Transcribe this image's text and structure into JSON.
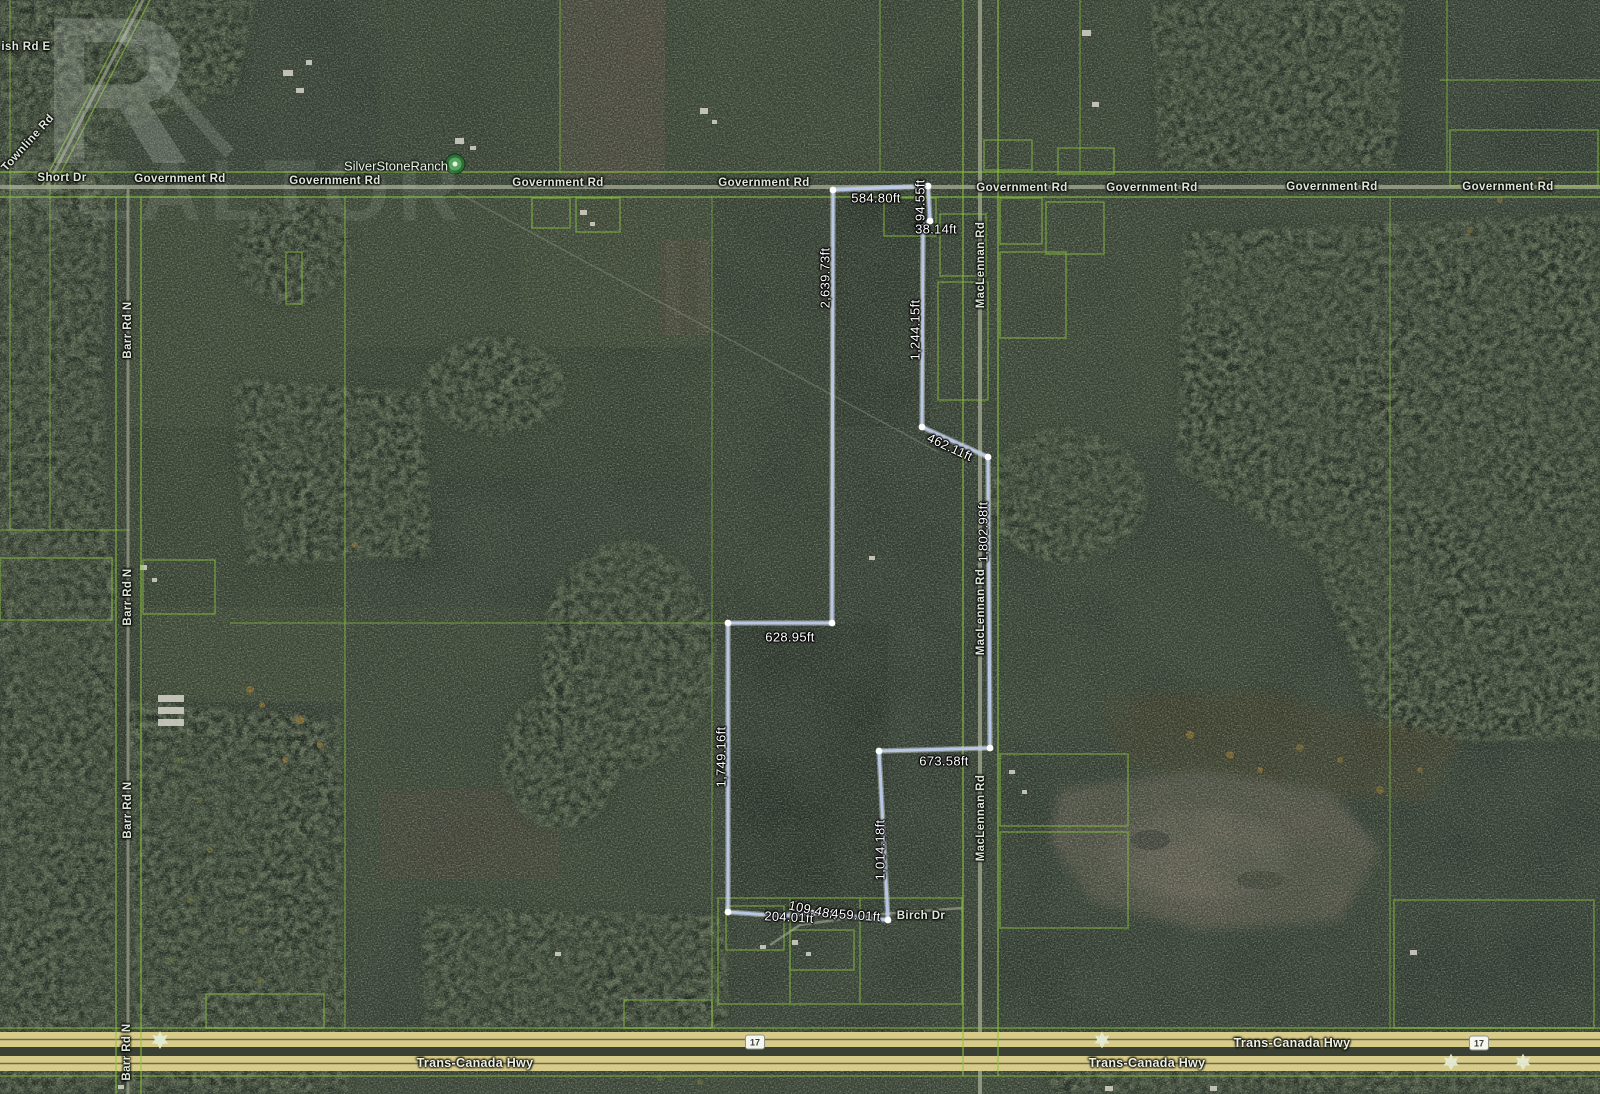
{
  "watermark": {
    "logo_letter": "R",
    "brand": "REALTOR"
  },
  "poi": {
    "name": "SilverStoneRanch"
  },
  "colors": {
    "boundary_line": "#b9c9ea",
    "vertex_dot": "#ffffff",
    "parcel_line": "#8cc63f",
    "highway_fill": "#d6cb88",
    "poi_marker_green": "#2c6e34"
  },
  "road_labels": [
    {
      "text": "ish Rd E",
      "x": 26,
      "y": 47,
      "rotate": 0
    },
    {
      "text": "Townline Rd",
      "x": 28,
      "y": 143,
      "rotate": -48
    },
    {
      "text": "Short Dr",
      "x": 62,
      "y": 178,
      "rotate": 0
    },
    {
      "text": "Government Rd",
      "x": 180,
      "y": 179,
      "rotate": 0
    },
    {
      "text": "Government Rd",
      "x": 335,
      "y": 181,
      "rotate": 0
    },
    {
      "text": "Government Rd",
      "x": 558,
      "y": 183,
      "rotate": 0
    },
    {
      "text": "Government Rd",
      "x": 764,
      "y": 183,
      "rotate": 0
    },
    {
      "text": "Government Rd",
      "x": 1022,
      "y": 188,
      "rotate": 0
    },
    {
      "text": "Government Rd",
      "x": 1152,
      "y": 188,
      "rotate": 0
    },
    {
      "text": "Government Rd",
      "x": 1332,
      "y": 187,
      "rotate": 0
    },
    {
      "text": "Government Rd",
      "x": 1508,
      "y": 187,
      "rotate": 0
    },
    {
      "text": "Barr Rd N",
      "x": 128,
      "y": 330,
      "rotate": -90
    },
    {
      "text": "Barr Rd N",
      "x": 128,
      "y": 597,
      "rotate": -90
    },
    {
      "text": "Barr Rd N",
      "x": 128,
      "y": 810,
      "rotate": -90
    },
    {
      "text": "Barr Rd N",
      "x": 127,
      "y": 1052,
      "rotate": -90
    },
    {
      "text": "MacLennan Rd",
      "x": 981,
      "y": 265,
      "rotate": -90
    },
    {
      "text": "MacLennan Rd",
      "x": 981,
      "y": 612,
      "rotate": -90
    },
    {
      "text": "MacLennan Rd",
      "x": 981,
      "y": 818,
      "rotate": -90
    },
    {
      "text": "Birch Dr",
      "x": 921,
      "y": 916,
      "rotate": 0
    }
  ],
  "highway_labels": [
    {
      "text": "Trans-Canada Hwy",
      "x": 475,
      "y": 1063,
      "rotate": 0
    },
    {
      "text": "Trans-Canada Hwy",
      "x": 1147,
      "y": 1063,
      "rotate": 0
    },
    {
      "text": "Trans-Canada Hwy",
      "x": 1292,
      "y": 1043,
      "rotate": 0
    }
  ],
  "highway_shields": [
    {
      "text": "17",
      "x": 755,
      "y": 1042
    },
    {
      "text": "17",
      "x": 1479,
      "y": 1043
    }
  ],
  "measurements": [
    {
      "text": "584.80ft",
      "x": 876,
      "y": 198,
      "rotate": 0
    },
    {
      "text": "194.55ft",
      "x": 920,
      "y": 204,
      "rotate": -90
    },
    {
      "text": "38.14ft",
      "x": 936,
      "y": 229,
      "rotate": 0
    },
    {
      "text": "1,244.15ft",
      "x": 915,
      "y": 330,
      "rotate": -90
    },
    {
      "text": "2,639.73ft",
      "x": 825,
      "y": 278,
      "rotate": -90
    },
    {
      "text": "462.11ft",
      "x": 950,
      "y": 447,
      "rotate": 25
    },
    {
      "text": "1,802.98ft",
      "x": 983,
      "y": 532,
      "rotate": -90
    },
    {
      "text": "628.95ft",
      "x": 790,
      "y": 637,
      "rotate": 0
    },
    {
      "text": "1,749.16ft",
      "x": 721,
      "y": 757,
      "rotate": -90
    },
    {
      "text": "673.58ft",
      "x": 944,
      "y": 761,
      "rotate": 0
    },
    {
      "text": "1,014.18ft",
      "x": 880,
      "y": 850,
      "rotate": -90
    },
    {
      "text": "204.01ft",
      "x": 789,
      "y": 917,
      "rotate": 3
    },
    {
      "text": "109.48ft",
      "x": 813,
      "y": 910,
      "rotate": 12
    },
    {
      "text": "459.01ft",
      "x": 856,
      "y": 915,
      "rotate": 4
    }
  ]
}
